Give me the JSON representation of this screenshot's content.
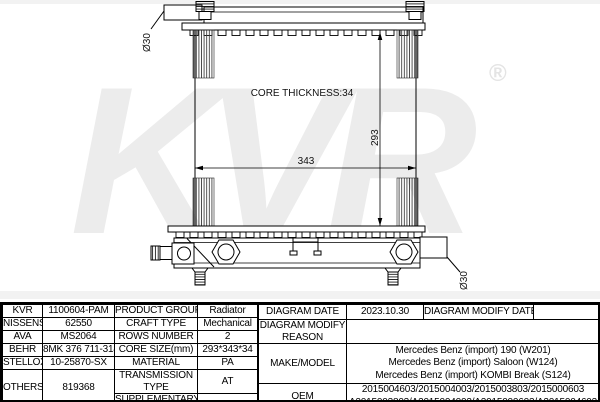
{
  "watermark": {
    "text": "KVR",
    "registered": "®"
  },
  "diagram": {
    "labels": {
      "top_diameter": "Ø30",
      "core_thickness": "CORE THICKNESS:34",
      "height_dim": "293",
      "width_dim": "343",
      "bottom_diameter": "Ø30"
    }
  },
  "table": {
    "left": {
      "rows": [
        {
          "brand": "KVR",
          "code": "1100604-PAM",
          "property": "PRODUCT GROUP",
          "value": "Radiator"
        },
        {
          "brand": "NISSENS",
          "code": "62550",
          "property": "CRAFT TYPE",
          "value": "Mechanical"
        },
        {
          "brand": "AVA",
          "code": "MS2064",
          "property": "ROWS NUMBER",
          "value": "2"
        },
        {
          "brand": "BEHR",
          "code": "8MK 376 711-314",
          "property": "CORE SIZE(mm)",
          "value": "293*343*34"
        },
        {
          "brand": "STELLOX",
          "code": "10-25870-SX",
          "property": "MATERIAL",
          "value": "PA"
        },
        {
          "brand": "OTHERS",
          "code": "819368",
          "property": "TRANSMISSION TYPE",
          "value": "AT"
        },
        {
          "property": "SUPPLEMENTARY",
          "value": ""
        }
      ]
    },
    "right": {
      "diagram_date_label": "DIAGRAM DATE",
      "diagram_date": "2023.10.30",
      "diagram_modify_date_label": "DIAGRAM MODIFY DATE",
      "diagram_modify_date": "",
      "modify_reason_label": "DIAGRAM MODIFY REASON",
      "modify_reason": "",
      "make_model_label": "MAKE/MODEL",
      "make_model": [
        "Mercedes Benz (import) 190 (W201)",
        "Mercedes Benz (import) Saloon (W124)",
        "Mercedes Benz (import) KOMBI Break (S124)"
      ],
      "oem_label": "OEM",
      "oem": [
        "2015004603/2015004003/2015003803/2015000603",
        "A2015003803/A2015004003/A2015000603/A2015004603"
      ]
    }
  }
}
